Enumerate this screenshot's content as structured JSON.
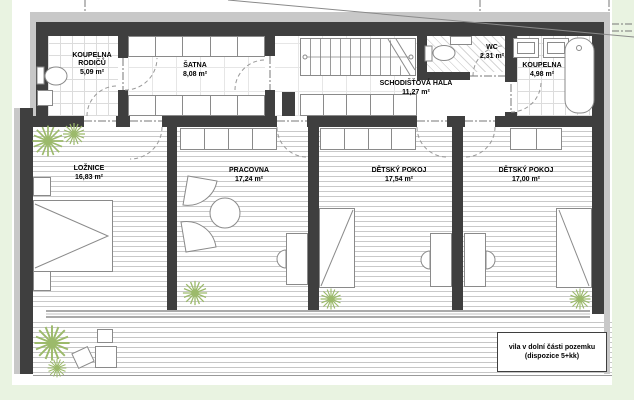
{
  "colors": {
    "background": "#e9f3e1",
    "sheet": "#ffffff",
    "wall": "#3f3f3f",
    "outer_band": "#c8c8c8",
    "plant_green": "#9cba6b",
    "furniture_stroke": "#8a8a8a",
    "text": "#000000"
  },
  "rooms": [
    {
      "name": "KOUPELNA\nRODIČŮ",
      "area": "5,09 m²"
    },
    {
      "name": "ŠATNA",
      "area": "8,08 m²"
    },
    {
      "name": "SCHODIŠŤOVÁ HALA",
      "area": "11,27 m²"
    },
    {
      "name": "WC",
      "area": "2,31 m²"
    },
    {
      "name": "KOUPELNA",
      "area": "4,98 m²"
    },
    {
      "name": "LOŽNICE",
      "area": "16,83 m²"
    },
    {
      "name": "PRACOVNA",
      "area": "17,24 m²"
    },
    {
      "name": "DĚTSKÝ POKOJ",
      "area": "17,54 m²"
    },
    {
      "name": "DĚTSKÝ POKOJ",
      "area": "17,00 m²"
    }
  ],
  "note": {
    "line1": "vila v dolní části pozemku",
    "line2": "(dispozice 5+kk)"
  },
  "fixtures": [
    "stairs",
    "bathtub",
    "washbasin",
    "toilet",
    "bed",
    "desk",
    "desk-chair",
    "armchair",
    "round-table",
    "wardrobe",
    "plant",
    "door-swing",
    "window",
    "terrace"
  ]
}
